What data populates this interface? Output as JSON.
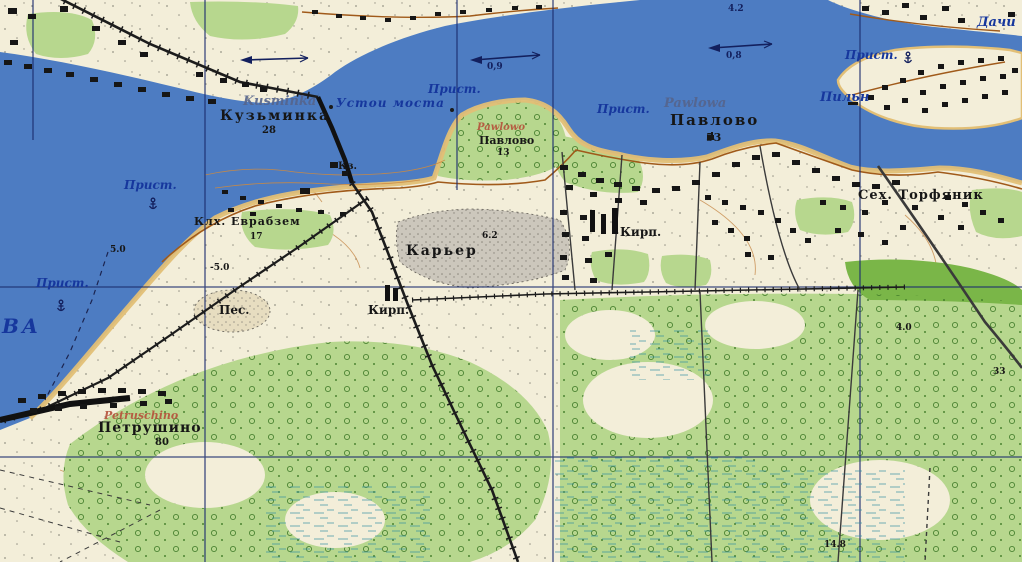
{
  "colors": {
    "water": "#4d7cc2",
    "land": "#f3eed9",
    "forest": "#b7d78e",
    "forest_dark": "#7ab648",
    "quarry_gray": "#ccc7bc",
    "road_brown": "#a05a1a",
    "shore_sand": "#e2bf76",
    "grid_blue": "#1b2d6e",
    "rail_black": "#1c1c1c",
    "label_blue": "#16379d",
    "label_black": "#161616",
    "label_red": "#b5503a"
  },
  "river": {
    "name_partial": "ВА",
    "pier_label": "Прист.",
    "bridge_ruins_label": "Устои моста",
    "depth_mark": "4.2",
    "flow_speeds": [
      "0,9",
      "0,8"
    ]
  },
  "settlements": {
    "kusminka": {
      "latin": "Kusminka",
      "cyrillic": "Кузьминка",
      "households": "28"
    },
    "pawlowo": {
      "latin": "Pawlowa",
      "cyrillic": "Павлово",
      "households": "53"
    },
    "pawlowo_small": {
      "latin": "Pawlowo",
      "cyrillic": "Павлово",
      "households": "13"
    },
    "petruschino": {
      "latin": "Petruschino",
      "cyrillic": "Петрушино",
      "households": "80"
    },
    "dachi_label": "Дачи",
    "pilnya_label": "Пильн",
    "kolkhoz": {
      "name": "Клх. Еврабзем",
      "households": "17"
    }
  },
  "features": {
    "quarry_label": "Карьер",
    "brickworks_label": "Кирп.",
    "sand_label": "Пес.",
    "peat_works_label": "Сех. Торфяник",
    "barracks_label": "Кз."
  },
  "spot_values": {
    "a": "5.0",
    "b": "-5.0",
    "c": "4.0",
    "d": "33",
    "e": "14.8",
    "f": "6.2"
  }
}
